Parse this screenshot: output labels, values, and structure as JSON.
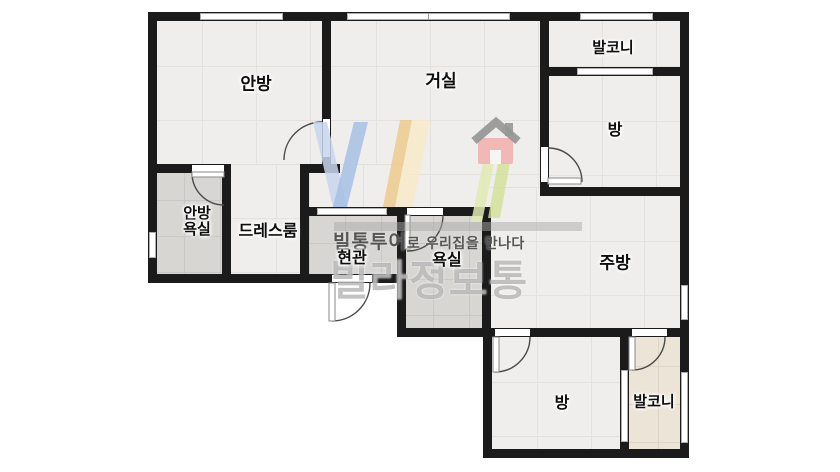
{
  "rooms": {
    "anbang": "안방",
    "geosil": "거실",
    "balcony_top": "발코니",
    "bang_top": "방",
    "anbang_yoksil_line1": "안방",
    "anbang_yoksil_line2": "욕실",
    "dressroom": "드레스룸",
    "hyeongwan": "현관",
    "yoksil": "욕실",
    "jubang": "주방",
    "bang_bottom": "방",
    "balcony_bottom": "발코니"
  },
  "watermark": {
    "tagline_head": "빌통투어",
    "tagline_tail": "로 우리집을 만나다",
    "brand": "빌라정보통"
  },
  "colors": {
    "wall": "#1b1b1b",
    "floor": "#f0eeec",
    "wet_area": "#d8d6d3",
    "balcony_floor": "#ece4d6",
    "logo_blue": "#a3bde4",
    "logo_yellow": "#f0cf94",
    "logo_green": "#d5e3a6",
    "logo_house_red": "#f2b1b1"
  }
}
